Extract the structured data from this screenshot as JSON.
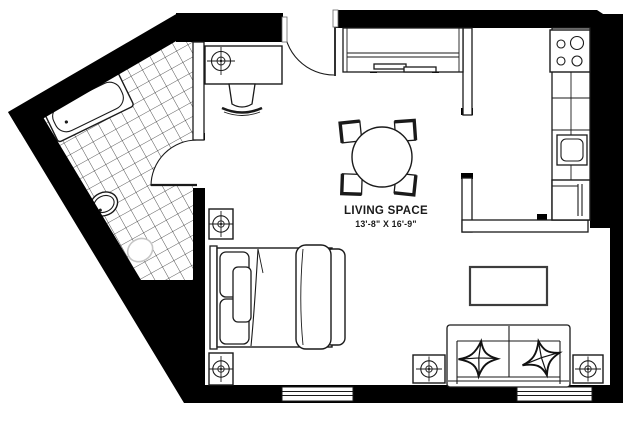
{
  "floor_plan": {
    "room_label": {
      "title": "LIVING SPACE",
      "dimensions": "13'-8\" X 16'-9\""
    },
    "colors": {
      "walls": "#000000",
      "lines": "#1a1a1a",
      "toilet_outline": "#c6c6c6",
      "background": "#ffffff"
    },
    "rooms": [
      {
        "name": "living-space",
        "label": "LIVING SPACE",
        "dimensions": "13'-8\" X 16'-9\""
      },
      {
        "name": "bathroom"
      },
      {
        "name": "kitchen"
      }
    ],
    "features": [
      "bathtub",
      "bathroom-sink",
      "toilet",
      "tiled-floor",
      "bathroom-door",
      "entry-door",
      "desk",
      "desk-chair",
      "closet-sliding-doors",
      "dining-table",
      "dining-chairs",
      "kitchen-counter",
      "stove",
      "kitchen-sink",
      "refrigerator",
      "counter-peninsula",
      "bed",
      "coffee-table",
      "sofa",
      "throw-pillows",
      "column-symbols",
      "windows"
    ]
  }
}
